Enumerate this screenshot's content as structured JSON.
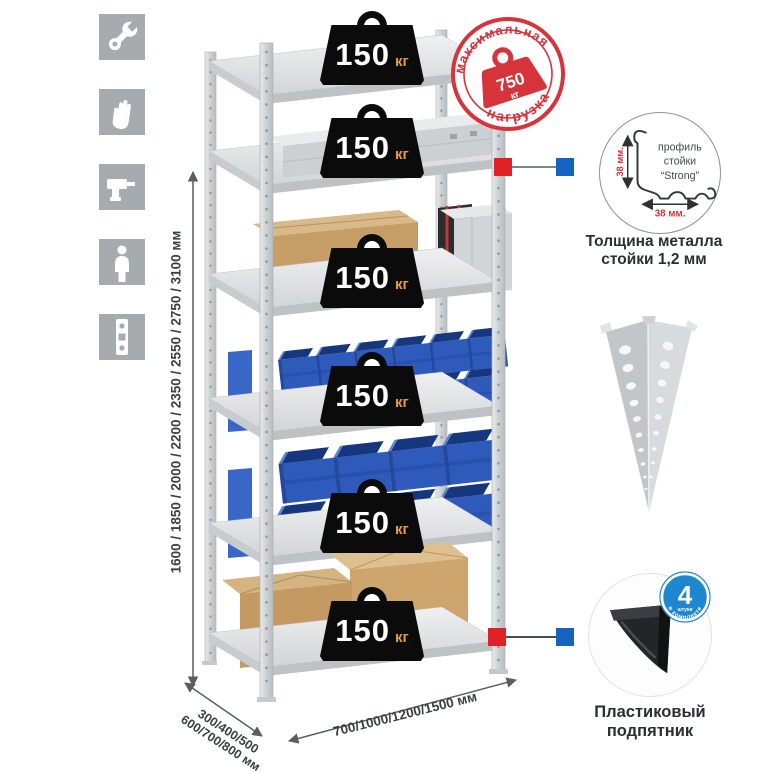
{
  "sidebar_icons": [
    {
      "name": "wrench"
    },
    {
      "name": "gloves"
    },
    {
      "name": "drill"
    },
    {
      "name": "person"
    },
    {
      "name": "level"
    }
  ],
  "dimensions": {
    "height": "1600 / 1850 / 2000 / 2200 / 2350 / 2550 / 2750 / 3100 мм",
    "depth_line1": "300/400/500",
    "depth_line2": "600/700/800 мм",
    "width": "700/1000/1200/1500 мм"
  },
  "max_load_stamp": {
    "arc_top": "максимальная",
    "arc_bottom": "нагрузка",
    "value": "750",
    "unit": "кг"
  },
  "shelf_load": {
    "value": "150",
    "unit": "кг",
    "shelf_count": 6
  },
  "profile_detail": {
    "line1": "профиль",
    "line2": "стойки",
    "line3": "“Strong”",
    "height_dim": "38 мм.",
    "width_dim": "38 мм.",
    "caption_line1": "Толщина металла",
    "caption_line2": "стойки 1,2 мм"
  },
  "foot_detail": {
    "badge_value": "4",
    "badge_note": "штуки",
    "badge_arc": "в комплекте",
    "caption_line1": "Пластиковый",
    "caption_line2": "подпятник"
  },
  "colors": {
    "stamp_red": "#d6333b",
    "connector_red": "#e02227",
    "connector_blue": "#1565c0",
    "badge_blue": "#1f86d0",
    "bin_blue": "#2e5bbb",
    "weight_unit_orange": "#e89b3c",
    "metal_gray": "#d9dbdc",
    "cardboard": "#c49a62"
  }
}
